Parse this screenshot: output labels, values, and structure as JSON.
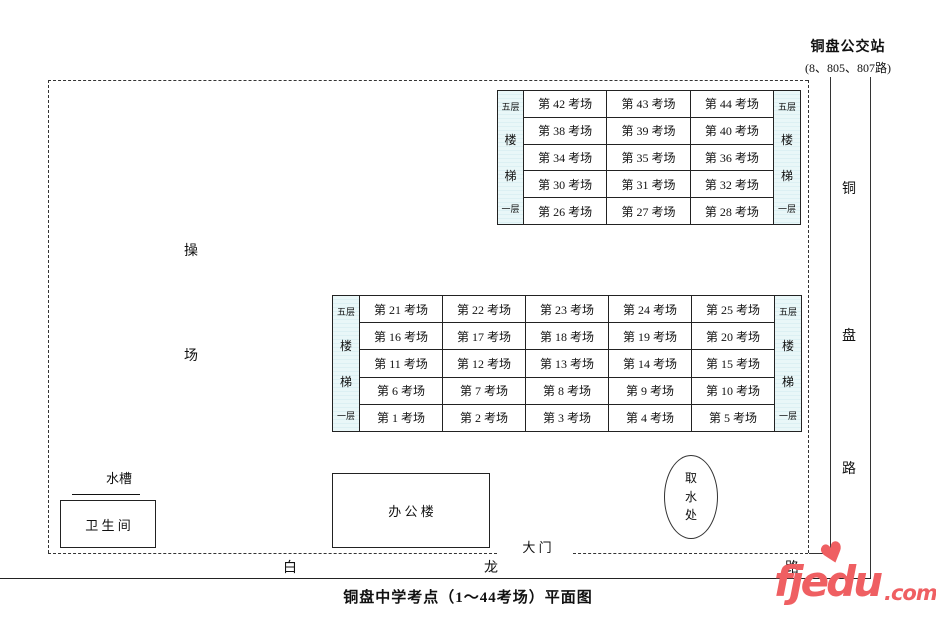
{
  "bus_station": {
    "name": "铜盘公交站",
    "routes": "(8、805、807路)"
  },
  "roads": {
    "tongpan_chars": [
      "铜",
      "盘",
      "路"
    ],
    "bailong_chars": [
      "白",
      "龙",
      "路"
    ]
  },
  "playground": {
    "chars": [
      "操",
      "场"
    ]
  },
  "gate": {
    "label": "大 门"
  },
  "annex_building": {
    "bands": [
      {
        "label": "第41考场",
        "chars": [
          "第",
          "41",
          "考",
          "场"
        ]
      },
      {
        "label": "第37考场",
        "chars": [
          "第",
          "37",
          "考",
          "场"
        ]
      },
      {
        "label": "第33考场",
        "chars": [
          "第",
          "33",
          "考",
          "场"
        ]
      },
      {
        "label": "第29考场",
        "chars": [
          "第",
          "29",
          "考",
          "场"
        ]
      },
      {
        "label": "考务室",
        "chars": [
          "考",
          "务",
          "室"
        ]
      }
    ]
  },
  "top_building": {
    "stair_labels": [
      "五层",
      "楼",
      "梯",
      "一层"
    ],
    "rows": [
      [
        "第 42 考场",
        "第 43 考场",
        "第 44 考场"
      ],
      [
        "第 38 考场",
        "第 39 考场",
        "第 40 考场"
      ],
      [
        "第 34 考场",
        "第 35 考场",
        "第 36 考场"
      ],
      [
        "第 30 考场",
        "第 31 考场",
        "第 32 考场"
      ],
      [
        "第 26 考场",
        "第 27 考场",
        "第 28 考场"
      ]
    ]
  },
  "main_building": {
    "stair_labels": [
      "五层",
      "楼",
      "梯",
      "一层"
    ],
    "rows": [
      [
        "第 21 考场",
        "第 22 考场",
        "第 23 考场",
        "第 24 考场",
        "第 25 考场"
      ],
      [
        "第 16 考场",
        "第 17 考场",
        "第 18 考场",
        "第 19 考场",
        "第 20 考场"
      ],
      [
        "第 11 考场",
        "第 12 考场",
        "第 13 考场",
        "第 14 考场",
        "第 15 考场"
      ],
      [
        "第 6 考场",
        "第 7 考场",
        "第 8 考场",
        "第 9 考场",
        "第 10 考场"
      ],
      [
        "第 1 考场",
        "第 2 考场",
        "第 3 考场",
        "第 4 考场",
        "第 5 考场"
      ]
    ]
  },
  "facilities": {
    "restroom": "卫 生 间",
    "water_trough": "水槽",
    "faucet_count": 5,
    "office": "办 公 楼",
    "water_point_chars": [
      "取",
      "水",
      "处"
    ]
  },
  "caption": "铜盘中学考点（1～44考场）平面图",
  "watermark": {
    "text_main": "fjedu",
    "text_suffix": ".com",
    "heart": "♥",
    "color": "#ef5f62"
  },
  "colors": {
    "stair_bg": "#e9f7f8",
    "stair_stripe": "#cfeaee",
    "line": "#222222"
  }
}
